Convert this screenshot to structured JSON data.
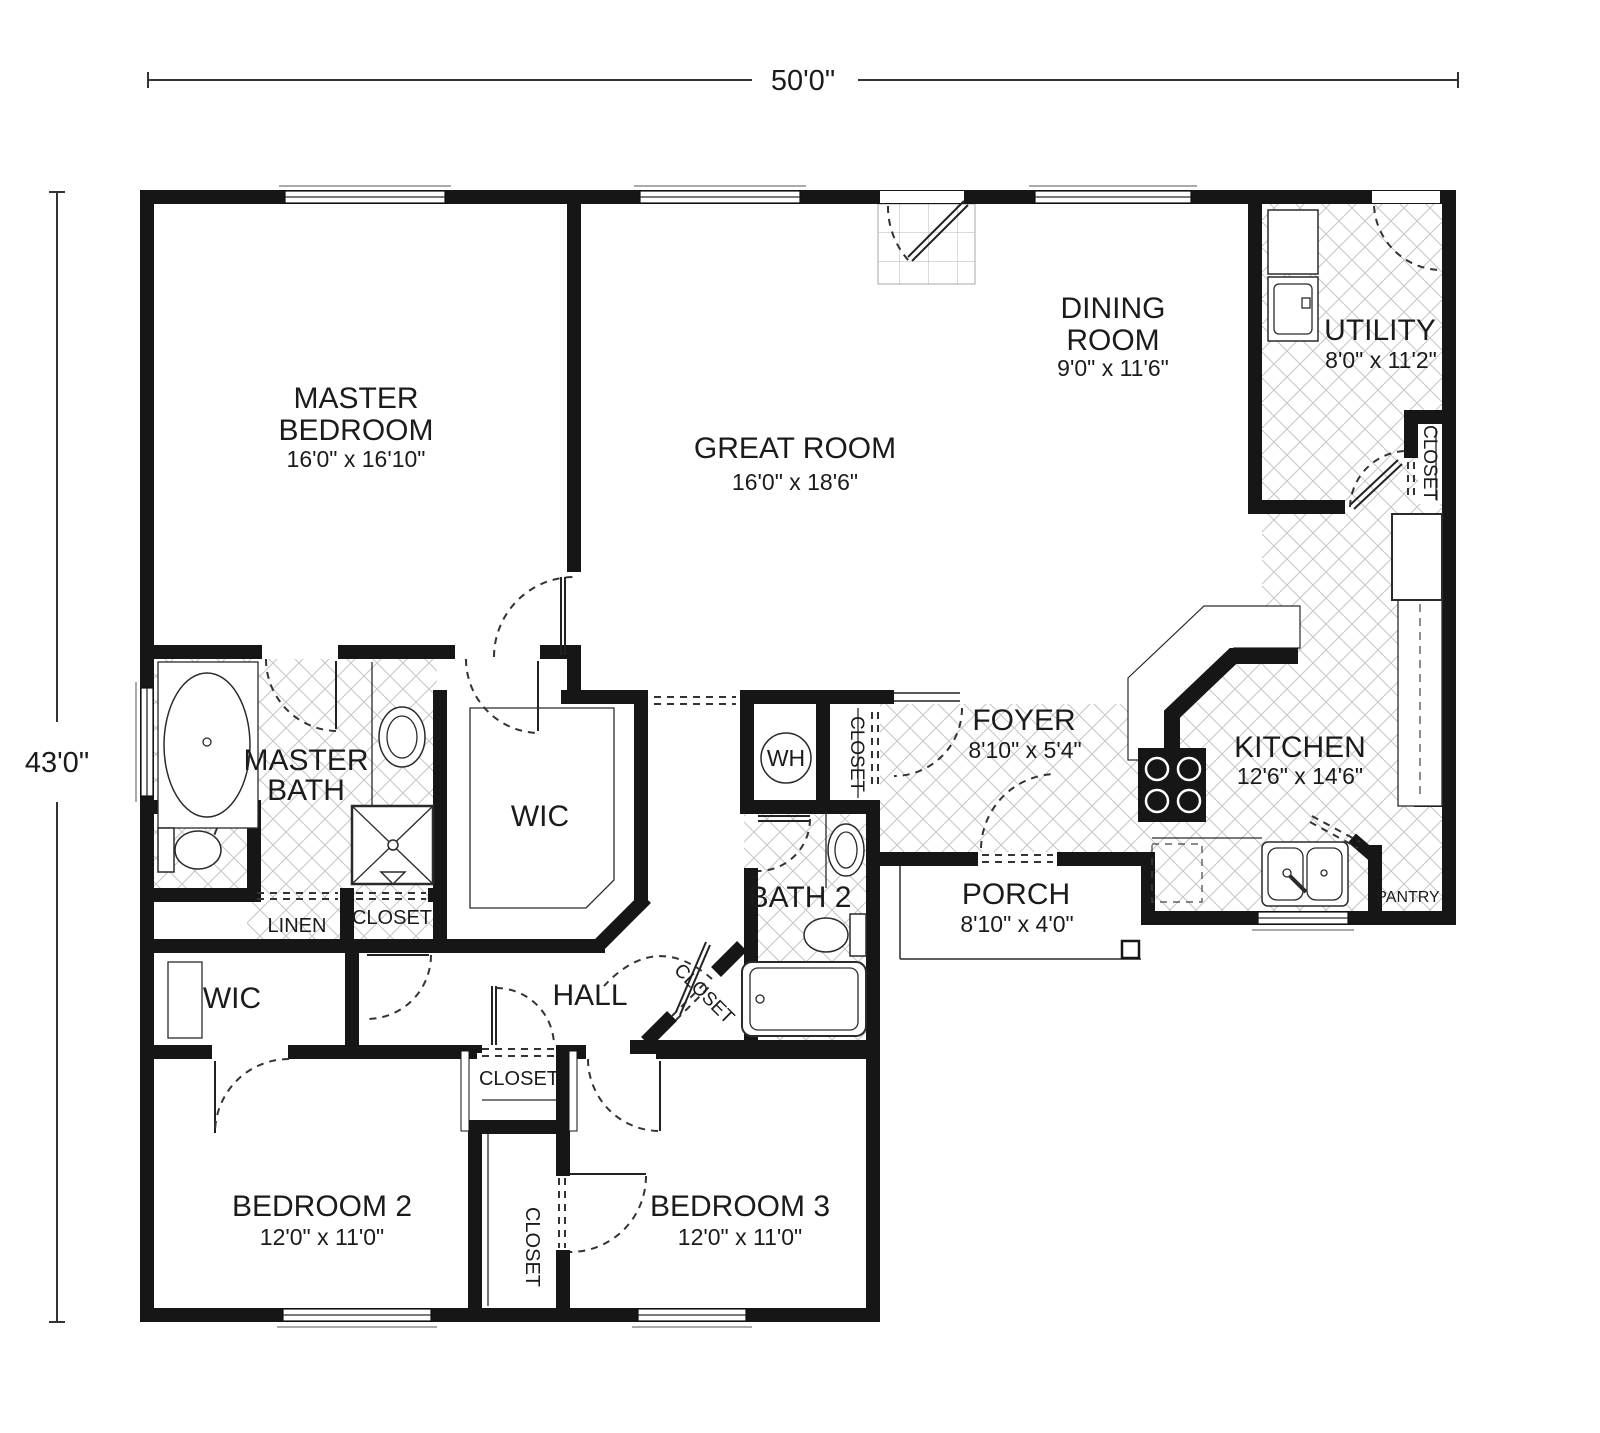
{
  "plan": {
    "overall_width": "50'0\"",
    "overall_height": "43'0\""
  },
  "rooms": {
    "master_bedroom": {
      "l1": "MASTER",
      "l2": "BEDROOM",
      "dims": "16'0\" x 16'10\""
    },
    "great_room": {
      "l1": "GREAT ROOM",
      "dims": "16'0\" x 18'6\""
    },
    "dining_room": {
      "l1": "DINING",
      "l2": "ROOM",
      "dims": "9'0\" x 11'6\""
    },
    "utility": {
      "l1": "UTILITY",
      "dims": "8'0\" x 11'2\""
    },
    "kitchen": {
      "l1": "KITCHEN",
      "dims": "12'6\" x 14'6\""
    },
    "foyer": {
      "l1": "FOYER",
      "dims": "8'10\" x 5'4\""
    },
    "porch": {
      "l1": "PORCH",
      "dims": "8'10\" x 4'0\""
    },
    "master_bath": {
      "l1": "MASTER",
      "l2": "BATH"
    },
    "bath2": {
      "l1": "BATH 2"
    },
    "bedroom2": {
      "l1": "BEDROOM 2",
      "dims": "12'0\" x 11'0\""
    },
    "bedroom3": {
      "l1": "BEDROOM 3",
      "dims": "12'0\" x 11'0\""
    },
    "hall": {
      "l1": "HALL"
    },
    "wic": {
      "l1": "WIC"
    },
    "wic2": {
      "l1": "WIC"
    },
    "linen": {
      "l1": "LINEN"
    },
    "pantry": {
      "l1": "PANTRY"
    },
    "water_heater": {
      "l1": "WH"
    },
    "closet_utility": {
      "l1": "CLOSET"
    },
    "closet_foyer": {
      "l1": "CLOSET"
    },
    "closet_master": {
      "l1": "CLOSET"
    },
    "closet_hall": {
      "l1": "CLOSET"
    },
    "closet_small": {
      "l1": "CLOSET"
    },
    "closet_bedroom": {
      "l1": "CLOSET"
    }
  }
}
